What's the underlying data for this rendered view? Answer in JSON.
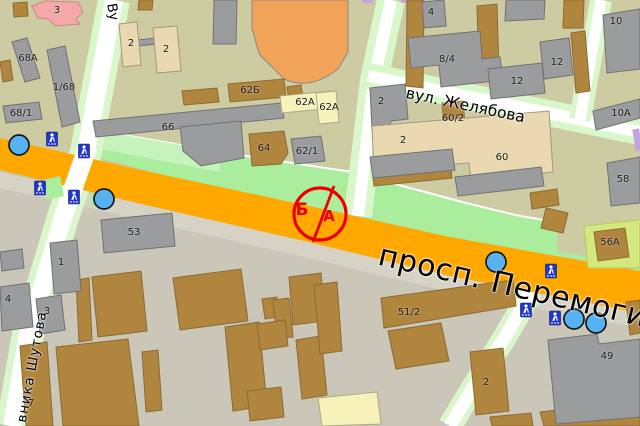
{
  "map_title": "city map fragment",
  "streets": {
    "avenue": "просп. Перемоги",
    "zhelyabova": "вул. Желябова",
    "shutova_partial": "вника Шутова",
    "vertical_partial": "Ву"
  },
  "annotation": {
    "left_letter": "Б",
    "right_letter": "А"
  },
  "building_labels": [
    {
      "t": "3"
    },
    {
      "t": "68А"
    },
    {
      "t": "1/68"
    },
    {
      "t": "68/1"
    },
    {
      "t": "2"
    },
    {
      "t": "2"
    },
    {
      "t": "62Б"
    },
    {
      "t": "62А"
    },
    {
      "t": "62А"
    },
    {
      "t": "66"
    },
    {
      "t": "64"
    },
    {
      "t": "62/1"
    },
    {
      "t": "4"
    },
    {
      "t": "8/4"
    },
    {
      "t": "12"
    },
    {
      "t": "12"
    },
    {
      "t": "10"
    },
    {
      "t": "10А"
    },
    {
      "t": "58"
    },
    {
      "t": "2"
    },
    {
      "t": "60/2"
    },
    {
      "t": "2"
    },
    {
      "t": "60"
    },
    {
      "t": "56А"
    },
    {
      "t": "53"
    },
    {
      "t": "1"
    },
    {
      "t": "4"
    },
    {
      "t": "3"
    },
    {
      "t": "7"
    },
    {
      "t": "51/2"
    },
    {
      "t": "2"
    },
    {
      "t": "49"
    }
  ],
  "icons": {
    "pedestrian_crossing": "blue square with white walking figure",
    "transit_stop": "blue circle",
    "annotation_marker": "red circle split by line"
  },
  "colors": {
    "avenue_orange": "#ffa800",
    "lawn_green": "#a9ed9d",
    "street_margin_green": "#d9f7ca",
    "north_background": "#cdcba2",
    "south_background": "#cac6b8",
    "building_gray": "#9b9c9e",
    "building_brown": "#b0853e",
    "building_beige": "#ead9b0",
    "building_pale_yellow": "#f6f2ba",
    "building_pink": "#f4a9a8",
    "special_building_orange": "#f1a359",
    "annotation_red": "#ee0000",
    "poi_blue": "#57b2f2",
    "crossing_icon_blue": "#2036cc",
    "tram_purple": "#c5a3e3",
    "allotment_green": "#d4e97d"
  }
}
